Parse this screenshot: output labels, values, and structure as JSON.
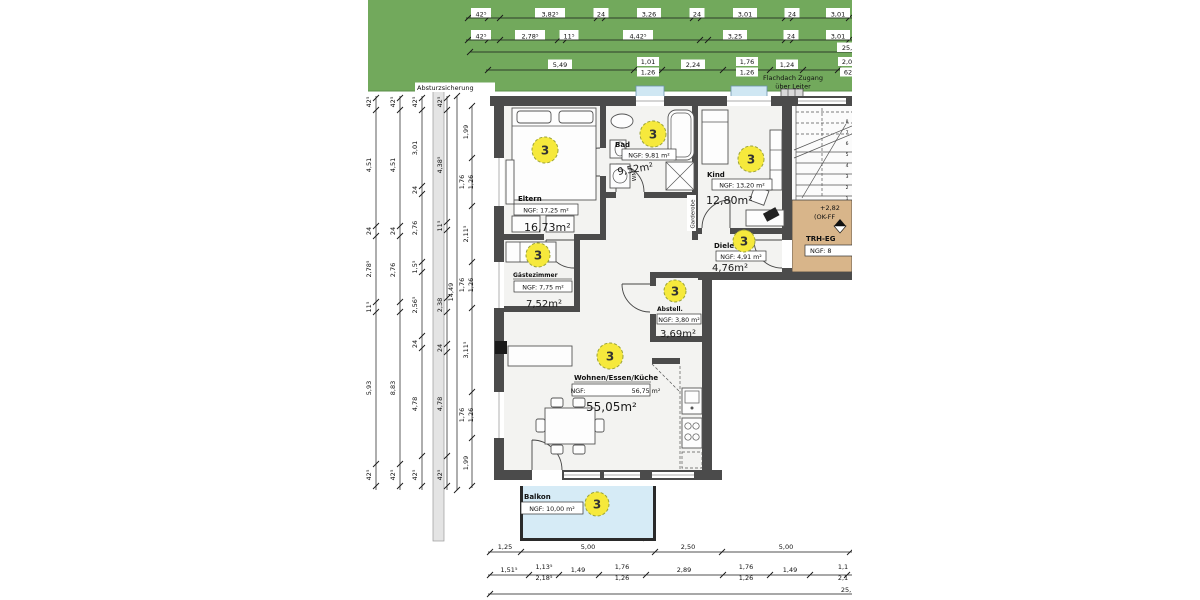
{
  "annotations": {
    "absturzsicherung": "Absturzsicherung",
    "flachdach_line1": "Flachdach Zugang",
    "flachdach_line2": "über Leiter",
    "garderobe": "Garderobe",
    "wm": "WM",
    "apartment_number": "3"
  },
  "rooms": [
    {
      "name": "Eltern",
      "ngf": "NGF: 17,25 m²",
      "area": "16,73m²"
    },
    {
      "name": "Bad",
      "ngf": "NGF: 9,81 m²",
      "area": "9,52m²"
    },
    {
      "name": "Kind",
      "ngf": "NGF: 13,20 m²",
      "area": "12,80m²"
    },
    {
      "name": "Diele",
      "ngf": "NGF: 4,91 m²",
      "area": "4,76m²"
    },
    {
      "name": "Gästezimmer",
      "ngf": "NGF: 7,75 m²",
      "area": "7,52m²"
    },
    {
      "name": "Abstell.",
      "ngf": "NGF: 3,80 m²",
      "area": "3,69m²"
    },
    {
      "name": "Wohnen/Essen/Küche",
      "ngf_label": "NGF:",
      "ngf_value": "56,75 m²",
      "area": "55,05m²"
    },
    {
      "name": "Balkon",
      "ngf": "NGF: 10,00 m²"
    }
  ],
  "stairwell": {
    "level": "+2,82",
    "level_ref": "(OK-FF",
    "name": "TRH-EG",
    "ngf": "NGF: 8"
  },
  "dims": {
    "top1": [
      "42⁵",
      "3,82⁵",
      "24",
      "3,26",
      "24",
      "3,01",
      "24",
      "3,01"
    ],
    "top2": [
      "42⁵",
      "2,78⁵",
      "11⁵",
      "4,42⁵",
      "3,25",
      "24",
      "3,01"
    ],
    "top_total": "25,",
    "top3": [
      "5,49",
      "1,01",
      "1,26",
      "2,24",
      "1,76",
      "1,26",
      "1,24",
      "2,0",
      "62"
    ],
    "left_a": [
      "42⁵",
      "4,51",
      "24",
      "2,78⁵",
      "11⁵",
      "5,93",
      "42⁵"
    ],
    "left_b": [
      "42⁵",
      "4,51",
      "24",
      "2,76",
      "8,83",
      "42⁵"
    ],
    "left_c": [
      "42⁵",
      "3,01",
      "24",
      "2,76",
      "1,5⁵",
      "2,56⁵",
      "24",
      "4,78",
      "42⁵"
    ],
    "left_d": [
      "42⁵",
      "4,38⁵",
      "11⁵",
      "2,38",
      "24",
      "4,78",
      "42⁵"
    ],
    "left_total": "14,49",
    "inner_left": [
      "1,99",
      "1,76",
      "1,26",
      "2,11⁵",
      "1,76",
      "1,26",
      "3,11⁵",
      "1,76",
      "1,26",
      "1,99"
    ],
    "bottom1": [
      "1,25",
      "5,00",
      "2,50",
      "5,00"
    ],
    "bottom2": [
      "1,51⁵",
      "1,13⁵",
      "2,18⁵",
      "1,49",
      "1,76",
      "1,26",
      "2,89",
      "1,76",
      "1,26",
      "1,49",
      "1,1",
      "2,1"
    ],
    "bottom_total": "25,",
    "balkon_depth": "2,00",
    "stair_steps": [
      "1",
      "2",
      "3",
      "4",
      "5",
      "6",
      "7",
      "8"
    ]
  },
  "colors": {
    "roof_green": "#72a95c",
    "wall_gray": "#4b4b4b",
    "floor_gray": "#f3f3f1",
    "glass_blue": "#cfe7f3",
    "balcony_blue": "#d6ebf6",
    "stair_tan": "#d8b58a",
    "marker_yellow": "#f6e93c",
    "parapet_gray": "#e4e4e4"
  }
}
